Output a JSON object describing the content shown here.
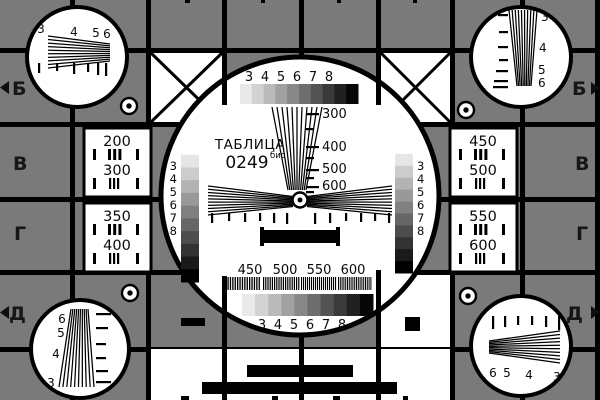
{
  "colors": {
    "background": "#7a7a7a",
    "grid": "#000000",
    "circle_fill": "#ffffff",
    "text": "#0a0a0a",
    "grayscale_horizontal": [
      "#e9e9e9",
      "#d2d2d2",
      "#bababa",
      "#a1a1a1",
      "#888888",
      "#6e6e6e",
      "#535353",
      "#3a3a3a",
      "#212121",
      "#070707"
    ],
    "grayscale_vertical": [
      "#ffffff",
      "#e6e6e6",
      "#cccccc",
      "#b3b3b3",
      "#999999",
      "#808080",
      "#666666",
      "#4d4d4d",
      "#333333",
      "#1a1a1a",
      "#000000"
    ]
  },
  "title": {
    "name": "ТАБЛИЦА",
    "number": "0249",
    "suffix": "бис"
  },
  "edge_markers": {
    "left": [
      "Б",
      "В",
      "Г",
      "Д"
    ],
    "right": [
      "Б",
      "В",
      "Г",
      "Д"
    ]
  },
  "corner_wedges": {
    "top_left": [
      "3",
      "4",
      "5",
      "6"
    ],
    "top_right": [
      "3",
      "4",
      "5",
      "6"
    ],
    "bottom_left": [
      "6",
      "5",
      "4",
      "3"
    ],
    "bottom_right": [
      "6",
      "5",
      "4",
      "3"
    ]
  },
  "resolution_boxes": {
    "left_top": [
      "200",
      "300"
    ],
    "left_bottom": [
      "350",
      "400"
    ],
    "right_top": [
      "450",
      "500"
    ],
    "right_bottom": [
      "550",
      "600"
    ]
  },
  "center": {
    "top_scale": [
      "3",
      "4",
      "5",
      "6",
      "7",
      "8"
    ],
    "wedge_scale": [
      "300",
      "400",
      "500",
      "600"
    ],
    "left_strip_scale": [
      "3",
      "4",
      "5",
      "6",
      "7",
      "8"
    ],
    "right_strip_scale": [
      "3",
      "4",
      "5",
      "6",
      "7",
      "8"
    ],
    "freq_scale": [
      "450",
      "500",
      "550",
      "600"
    ],
    "bottom_scale": [
      "3",
      "4",
      "5",
      "6",
      "7",
      "8"
    ]
  }
}
